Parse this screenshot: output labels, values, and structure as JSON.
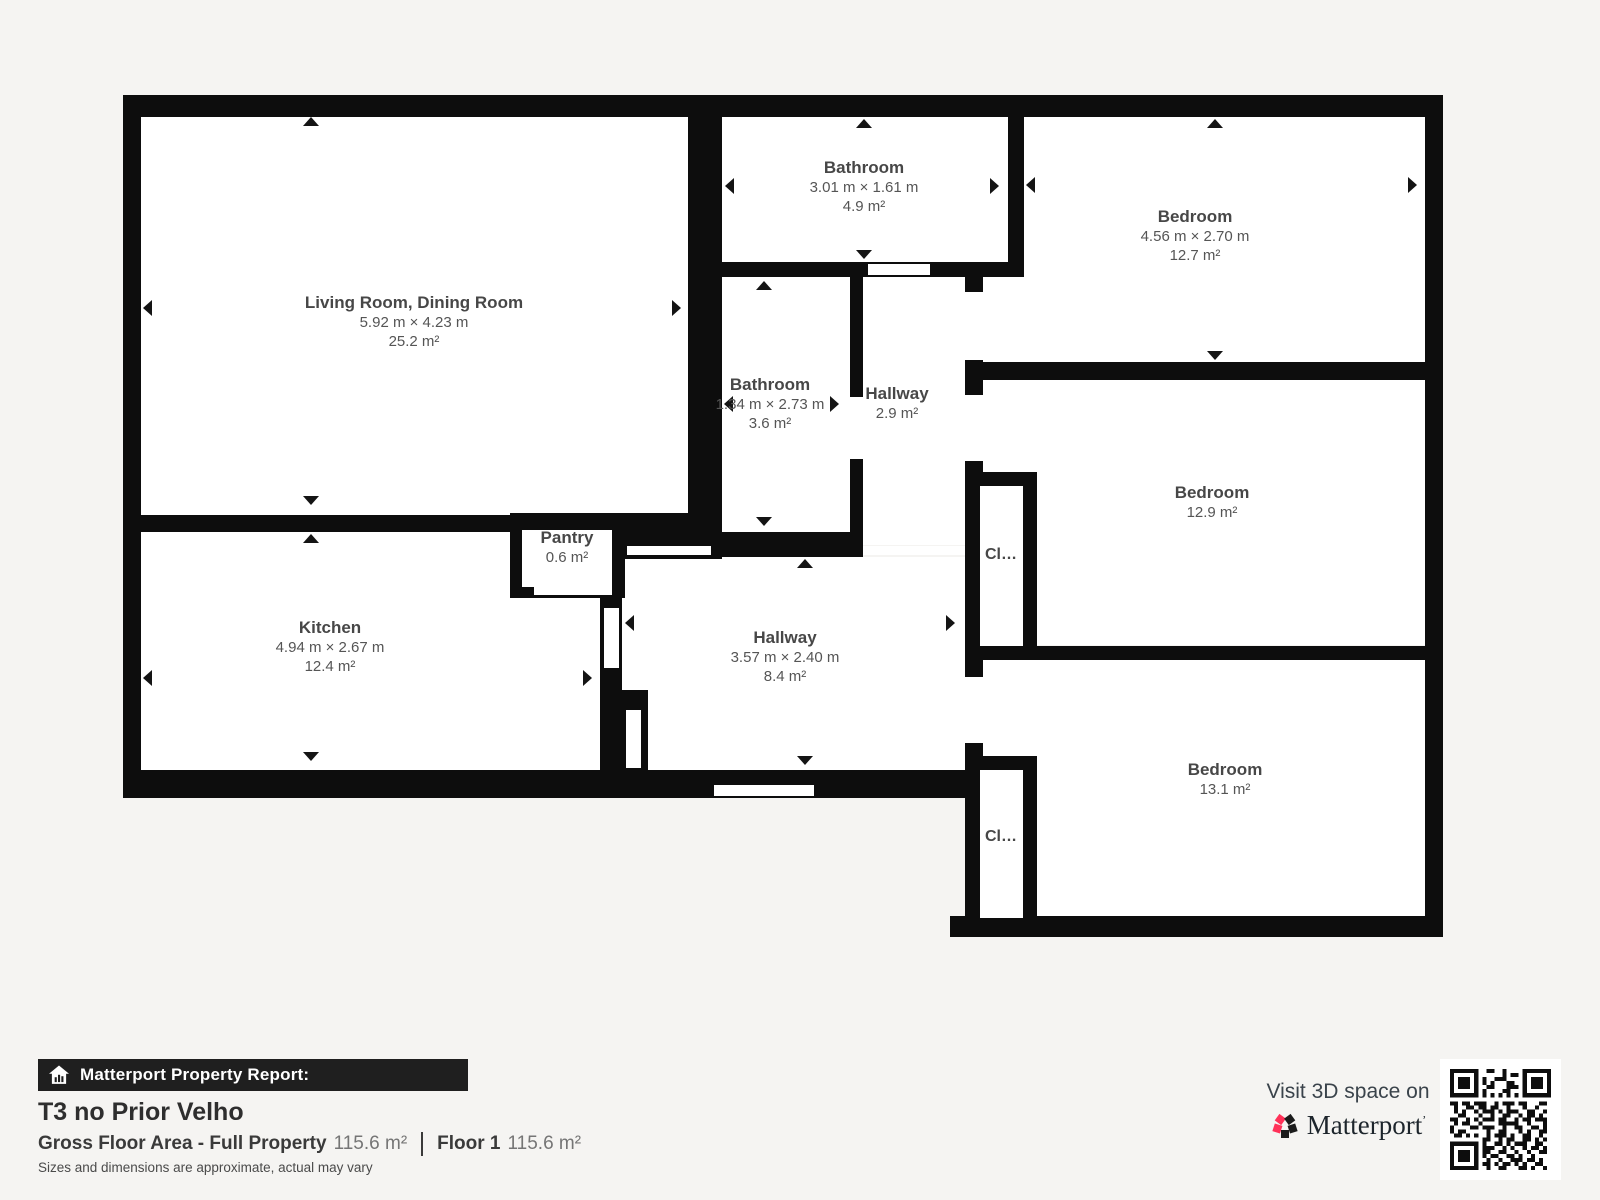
{
  "colors": {
    "background": "#f5f4f2",
    "wall": "#0d0d0d",
    "room_fill": "#ffffff",
    "brand_pink": "#ff3158",
    "bar_background": "#1f1f1f"
  },
  "plan": {
    "rooms": {
      "living": {
        "name": "Living Room, Dining Room",
        "dims": "5.92 m × 4.23 m",
        "area": "25.2 m²"
      },
      "bath_top": {
        "name": "Bathroom",
        "dims": "3.01 m × 1.61 m",
        "area": "4.9 m²"
      },
      "bedroom_tr": {
        "name": "Bedroom",
        "dims": "4.56 m × 2.70 m",
        "area": "12.7 m²"
      },
      "bath_mid": {
        "name": "Bathroom",
        "dims": "1.34 m × 2.73 m",
        "area": "3.6 m²"
      },
      "hall_small": {
        "name": "Hallway",
        "area": "2.9 m²"
      },
      "bedroom_mr": {
        "name": "Bedroom",
        "area": "12.9 m²"
      },
      "pantry": {
        "name": "Pantry",
        "area": "0.6 m²"
      },
      "kitchen": {
        "name": "Kitchen",
        "dims": "4.94 m × 2.67 m",
        "area": "12.4 m²"
      },
      "hall_main": {
        "name": "Hallway",
        "dims": "3.57 m × 2.40 m",
        "area": "8.4 m²"
      },
      "bedroom_br": {
        "name": "Bedroom",
        "area": "13.1 m²"
      },
      "closet_mid": {
        "name": "Cl…"
      },
      "closet_bot": {
        "name": "Cl…"
      }
    }
  },
  "footer": {
    "report_label": "Matterport Property Report:",
    "title": "T3 no Prior Velho",
    "gross_label": "Gross Floor Area - Full Property",
    "gross_value": "115.6 m²",
    "floor_label": "Floor 1",
    "floor_value": "115.6 m²",
    "disclaimer": "Sizes and dimensions are approximate, actual may vary"
  },
  "branding": {
    "visit_text": "Visit 3D space on",
    "brand_name": "Matterport",
    "trademark": "ʼ"
  }
}
